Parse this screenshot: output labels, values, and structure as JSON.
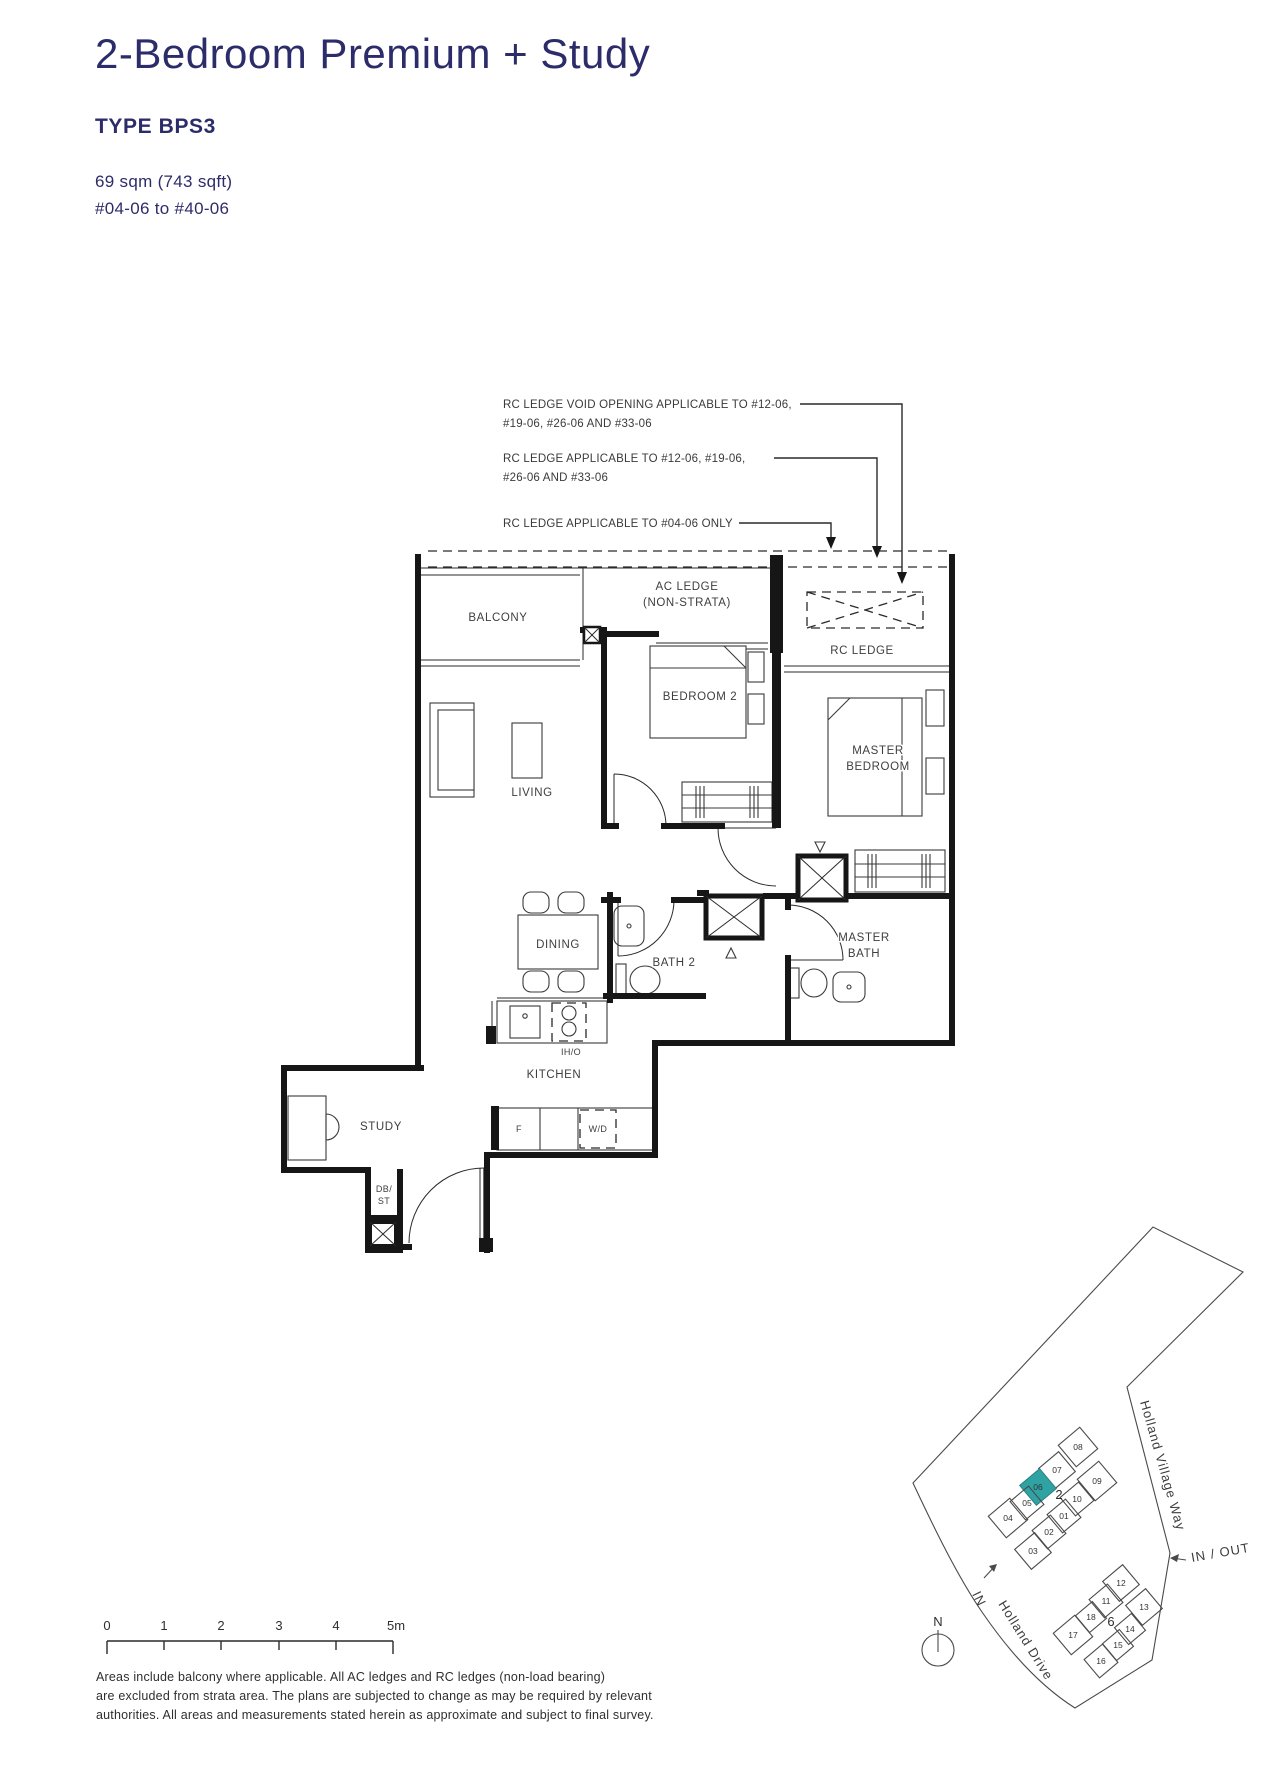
{
  "header": {
    "title": "2-Bedroom Premium + Study",
    "type": "TYPE BPS3",
    "area": "69 sqm (743 sqft)",
    "units": "#04-06 to #40-06"
  },
  "annotations": {
    "rc_void_line1": "RC LEDGE VOID OPENING APPLICABLE TO #12-06,",
    "rc_void_line2": "#19-06, #26-06 AND #33-06",
    "rc_ledge_line1": "RC LEDGE APPLICABLE TO #12-06, #19-06,",
    "rc_ledge_line2": "#26-06 AND #33-06",
    "rc_ledge_0406": "RC LEDGE APPLICABLE TO #04-06 ONLY"
  },
  "rooms": {
    "balcony": "BALCONY",
    "ac_ledge_1": "AC LEDGE",
    "ac_ledge_2": "(NON-STRATA)",
    "rc_ledge": "RC LEDGE",
    "bedroom2": "BEDROOM 2",
    "master_1": "MASTER",
    "master_2": "BEDROOM",
    "living": "LIVING",
    "dining": "DINING",
    "bath2": "BATH 2",
    "master_bath_1": "MASTER",
    "master_bath_2": "BATH",
    "kitchen": "KITCHEN",
    "study": "STUDY",
    "db_1": "DB/",
    "db_2": "ST",
    "iho": "IH/O",
    "fridge": "F",
    "wd": "W/D"
  },
  "scale_bar": {
    "labels": [
      "0",
      "1",
      "2",
      "3",
      "4",
      "5m"
    ]
  },
  "site_plan": {
    "road1": "Holland Village Way",
    "road2": "Holland Drive",
    "in_out": "IN / OUT",
    "in_label": "IN",
    "north": "N",
    "block2": "2",
    "block6": "6",
    "highlighted_stack": "06",
    "highlight_color": "#2fa3a3",
    "stacks": {
      "s01": "01",
      "s02": "02",
      "s03": "03",
      "s04": "04",
      "s05": "05",
      "s06": "06",
      "s07": "07",
      "s08": "08",
      "s09": "09",
      "s10": "10",
      "s11": "11",
      "s12": "12",
      "s13": "13",
      "s14": "14",
      "s15": "15",
      "s16": "16",
      "s17": "17",
      "s18": "18"
    }
  },
  "disclaimer": {
    "line1": "Areas include balcony where applicable. All AC ledges and RC ledges (non-load bearing)",
    "line2": "are excluded from strata area. The plans are subjected to change as may be required by relevant",
    "line3": "authorities. All areas and measurements stated herein as approximate and subject to final survey."
  },
  "colors": {
    "accent_navy": "#2c2c6a",
    "highlight_teal": "#2fa3a3"
  }
}
